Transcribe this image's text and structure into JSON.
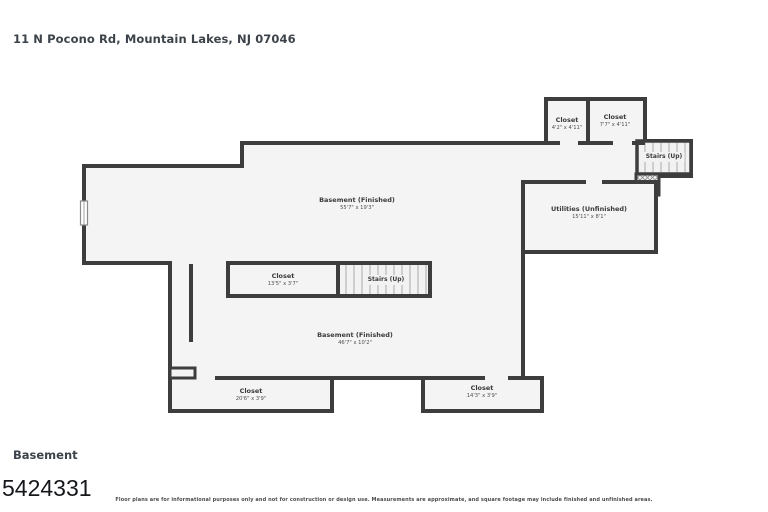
{
  "header": {
    "title": "11 N Pocono Rd, Mountain Lakes, NJ 07046"
  },
  "footer": {
    "floor_label": "Basement",
    "listing_id": "5424331",
    "disclaimer": "Floor plans are for informational purposes only and not for construction or design use. Measurements are approximate, and square footage may include finished and unfinished areas."
  },
  "colors": {
    "wall": "#3d3d3d",
    "floor_fill": "#f4f4f4",
    "label_text": "#3a3a3a",
    "background": "#ffffff"
  },
  "rooms": {
    "basement_upper": {
      "name": "Basement (Finished)",
      "dims": "55'7\" x 19'3\""
    },
    "closet_top_small": {
      "name": "Closet",
      "dims": "4'2\" x 4'11\""
    },
    "closet_top_large": {
      "name": "Closet",
      "dims": "7'7\" x 4'11\""
    },
    "stairs_top": {
      "name": "Stairs (Up)"
    },
    "utilities": {
      "name": "Utilities (Unfinished)",
      "dims": "15'11\" x 8'1\""
    },
    "closet_mid": {
      "name": "Closet",
      "dims": "13'5\" x 3'7\""
    },
    "stairs_mid": {
      "name": "Stairs (Up)"
    },
    "basement_lower": {
      "name": "Basement (Finished)",
      "dims": "46'7\" x 10'2\""
    },
    "closet_bottom_left": {
      "name": "Closet",
      "dims": "20'6\" x 3'9\""
    },
    "closet_bottom_right": {
      "name": "Closet",
      "dims": "14'3\" x 3'9\""
    }
  }
}
